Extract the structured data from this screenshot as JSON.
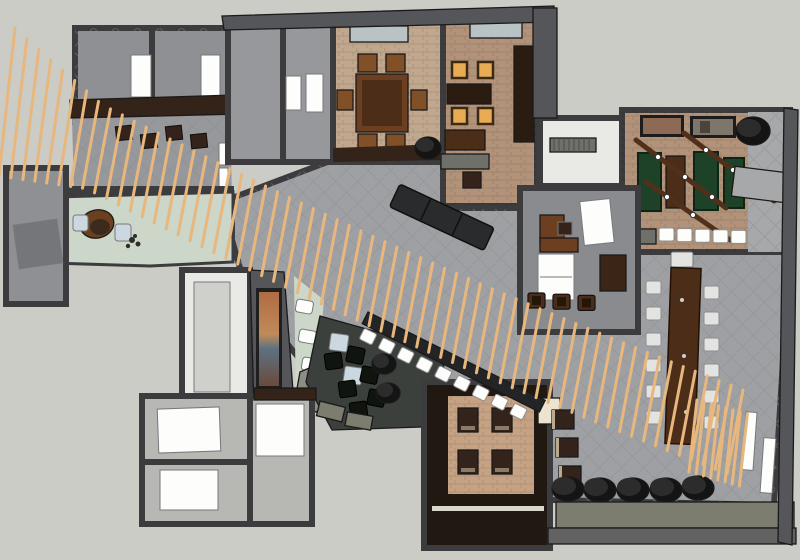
{
  "scene": {
    "type": "3d-floorplan-render",
    "description": "Top-down SketchUp-style 3D rendering of a hospitality interior floor plan with a long diagonal wooden-slat screen crossing the space",
    "view": "overhead-axonometric"
  },
  "palette": {
    "bg": "#cbccc6",
    "wall": "#55565a",
    "wallDark": "#3c3c3e",
    "outline": "#1a1a1a",
    "hall": "#9fa0a4",
    "floorGray": "#8f9094",
    "floorGray2": "#97989c",
    "tan": "#c1a78d",
    "brick": "#b2937a",
    "brickLight": "#a7a8aa",
    "mint": "#ccd6c9",
    "whiteFloor": "#e9e9e5",
    "whitePad": "#fdfdfb",
    "darkLounge": "#3b403c",
    "darkWood": "#211811",
    "rug": "#c6a284",
    "woodMid": "#6b3f1f",
    "woodChair": "#815026",
    "woodDark": "#4c2d18",
    "woodDeep": "#2b1c12",
    "green": "#1d4227",
    "slat": "#e7b77e",
    "amber": "#e9ac54",
    "blueSeat": "#ccd8e0",
    "olive": "#7c7d6e",
    "black": "#141414",
    "black2": "#2c2c2c",
    "seatWhite": "#e3e3e1",
    "stone": "#8d8c85",
    "ivory": "#ece4cf",
    "skylight": "#b9c3c5",
    "brownBand": "#342318",
    "darkSeat": "#33231a",
    "benchGray": "#6f7069",
    "counter": "#232426",
    "rail": "#50301b"
  },
  "rooms": [
    {
      "id": "topleft-rooms",
      "name": "two small rooms, upper-left"
    },
    {
      "id": "kitchen-block",
      "name": "service corridor block"
    },
    {
      "id": "dining-room-a",
      "name": "private dining room with wooden table and six chairs"
    },
    {
      "id": "dining-room-b",
      "name": "private dining room with four lit chairs"
    },
    {
      "id": "white-corridor",
      "name": "white entry corridor"
    },
    {
      "id": "game-room",
      "name": "game room with green shuffleboard tables"
    },
    {
      "id": "main-hall",
      "name": "large central hall with tiled floor"
    },
    {
      "id": "reception",
      "name": "reception with curved desk on mint floor"
    },
    {
      "id": "left-room",
      "name": "small room on left wing"
    },
    {
      "id": "white-room-mid",
      "name": "bright white-floored room"
    },
    {
      "id": "art-lounge",
      "name": "lounge with artwork wall, benches and stone feature"
    },
    {
      "id": "dark-lounge",
      "name": "dark-carpet lounge with poufs and side tables"
    },
    {
      "id": "white-rooms-bottom",
      "name": "white-padded rooms, bottom-left block"
    },
    {
      "id": "stair-lounge",
      "name": "dark-wood area with rug and four armchairs"
    },
    {
      "id": "office",
      "name": "small office with desk and daybed"
    }
  ],
  "generated": {
    "slats": {
      "count": 62
    },
    "fence_slats": {
      "count": 8
    },
    "bar_stools": {
      "count": 9
    },
    "communal_chairs_per_side": 6,
    "pouf_row": {
      "count": 5
    },
    "game_stools": {
      "count": 5
    },
    "lounge_poufs": {
      "count": 6
    },
    "workstation_chairs": {
      "count": 4
    }
  },
  "furniture_summary": {
    "dining_a_chairs": 6,
    "dining_b_lit_chairs": 4,
    "green_game_tables": 3,
    "hanging_light_rails": 3,
    "framed_pictures": 2,
    "communal_table_seats": 13,
    "rug_armchairs": 4,
    "wall_chairs": 3,
    "reception_chairs": 2,
    "white_benches": 3,
    "black_floor_cylinders": 4
  }
}
